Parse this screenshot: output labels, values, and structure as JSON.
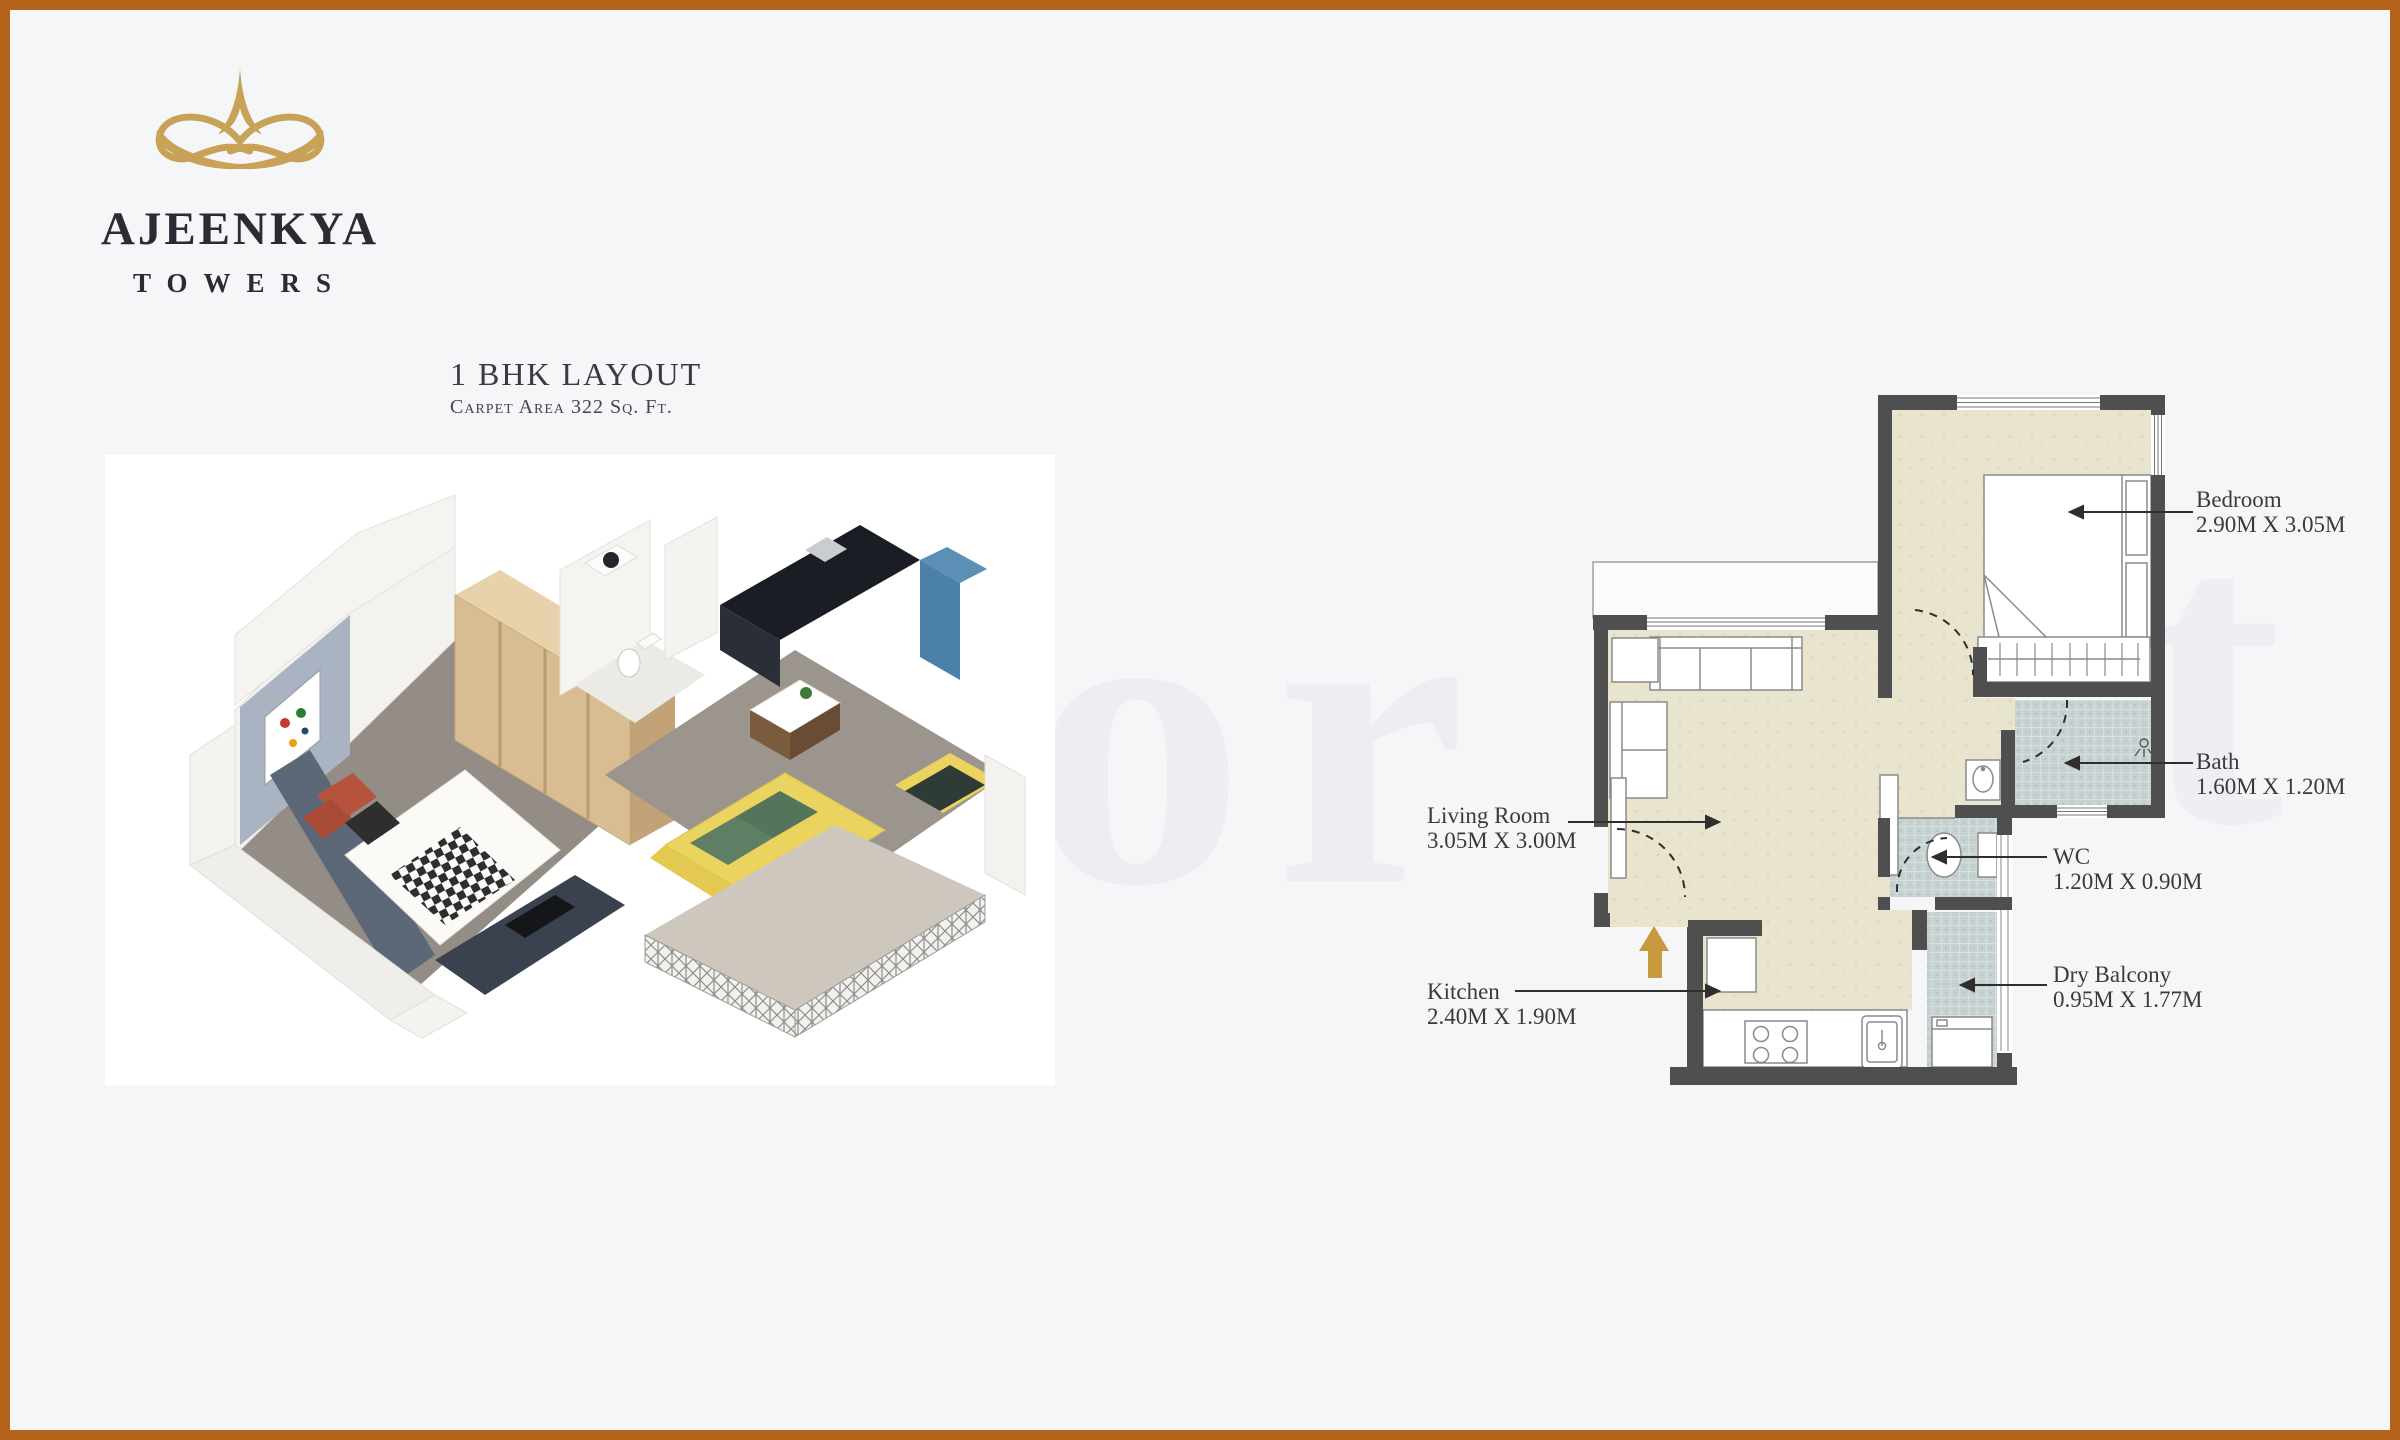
{
  "brand": {
    "name": "AJEENKYA",
    "tagline": "TOWERS"
  },
  "heading": {
    "title": "1 BHK LAYOUT",
    "subtitle": "Carpet Area 322 Sq. Ft."
  },
  "floor_plan": {
    "rooms": [
      {
        "id": "living-room",
        "label": "Living Room",
        "dimensions": "3.05M X 3.00M"
      },
      {
        "id": "kitchen",
        "label": "Kitchen",
        "dimensions": "2.40M X 1.90M"
      },
      {
        "id": "bedroom",
        "label": "Bedroom",
        "dimensions": "2.90M X 3.05M"
      },
      {
        "id": "bath",
        "label": "Bath",
        "dimensions": "1.60M X 1.20M"
      },
      {
        "id": "wc",
        "label": "WC",
        "dimensions": "1.20M X 0.90M"
      },
      {
        "id": "dry-balcony",
        "label": "Dry Balcony",
        "dimensions": "0.95M X 1.77M"
      }
    ],
    "icons": {
      "entry_arrow": "entry-direction-arrow",
      "shower": "shower-icon"
    },
    "colors": {
      "wall": "#4F4F4F",
      "floor": "#E9E4CE",
      "wet_area_tile": "#C6D1D2",
      "entry_arrow": "#C9993F"
    }
  },
  "render": {
    "description_icon": "isometric-3d-apartment-render"
  },
  "watermark": {
    "text_left": "or",
    "text_right": "t"
  },
  "theme": {
    "frame": "#B4611A",
    "background": "#F5F6F8",
    "gold": "#C8A357",
    "ink": "#2B2B34"
  }
}
